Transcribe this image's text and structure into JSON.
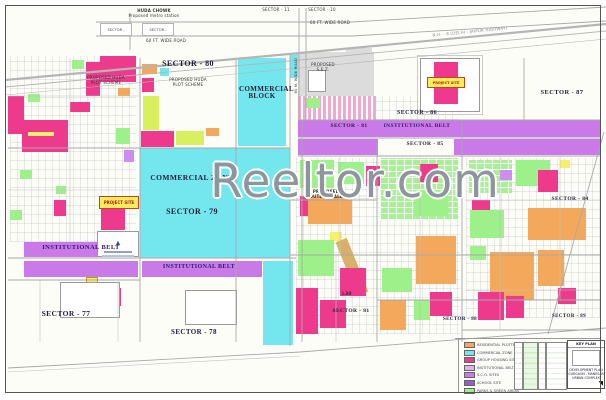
{
  "watermark": {
    "text": "Reeltor.com"
  },
  "colors": {
    "institutional_belt": "#c97ae8",
    "commercial": "#74e6ee",
    "group_housing": "#ee3a8c",
    "residential": "#f4a85c",
    "green_area": "#9ef08a",
    "highlight": "#f7ef5a"
  },
  "top": {
    "chowk_line1": "HUDA CHOWK",
    "chowk_line2": "Proposed metro station",
    "sector_box_left": "SECTOR -",
    "sector_box_right": "SECTOR -",
    "sector_11": "SECTOR - 11",
    "sector_10": "SECTOR - 10",
    "road_60ft_a": "60 FT. WIDE ROAD",
    "road_60ft_b": "60 FT. WIDE ROAD",
    "road_60m": "60 M. WIDE ROAD",
    "highway": "N.H. - 8 (DELHI - JAIPUR HIGHWAY)"
  },
  "sectors": {
    "s77": "SECTOR - 77",
    "s78": "SECTOR - 78",
    "s79": "SECTOR - 79",
    "s80": "SECTOR - 80",
    "s81_band": "SECTOR - 81",
    "s81_south": "SECTOR - 81",
    "s84": "SECTOR - 84",
    "s85": "SECTOR - 85",
    "s86": "SECTOR - 86",
    "s87": "SECTOR - 87",
    "s88": "SECTOR - 88",
    "s89": "SECTOR - 89"
  },
  "areas": {
    "commercial_block_l1": "COMMERCIAL",
    "commercial_block_l2": "BLOCK",
    "commercial_zone": "COMMERCIAL ZONE",
    "institutional_belt_left": "INSTITUTIONAL BELT",
    "institutional_belt_center": "INSTITUTIONAL BELT",
    "institutional_belt_right": "INSTITUTIONAL BELT",
    "sez_l1": "PROPOSED",
    "sez_l2": "S.E.Z.",
    "huda_l1": "PROPOSED HUDA",
    "huda_l2": "PLOT SCHEME",
    "outlet_l1": "PROPOSED",
    "outlet_l2": "OUTLET MALL",
    "l30": "L30"
  },
  "project": {
    "banner": "PROJECT SITE"
  },
  "legend": {
    "items": [
      {
        "color": "#f4a85c",
        "label": "RESIDENTIAL PLOTTED AREA"
      },
      {
        "color": "#74e6ee",
        "label": "COMMERCIAL ZONE"
      },
      {
        "color": "#ee3a8c",
        "label": "GROUP HOUSING SITE"
      },
      {
        "color": "#e0b0f5",
        "label": "INSTITUTIONAL BELT"
      },
      {
        "color": "#c97ae8",
        "label": "S.C.O. SITES"
      },
      {
        "color": "#9b59d0",
        "label": "SCHOOL SITE"
      },
      {
        "color": "#9ef08a",
        "label": "PARKS & GREEN AREAS"
      }
    ]
  },
  "titleblock": {
    "title": "KEY PLAN",
    "line1": "DEVELOPMENT PLAN",
    "line2": "GURGAON - MANESAR",
    "line3": "URBAN COMPLEX"
  }
}
